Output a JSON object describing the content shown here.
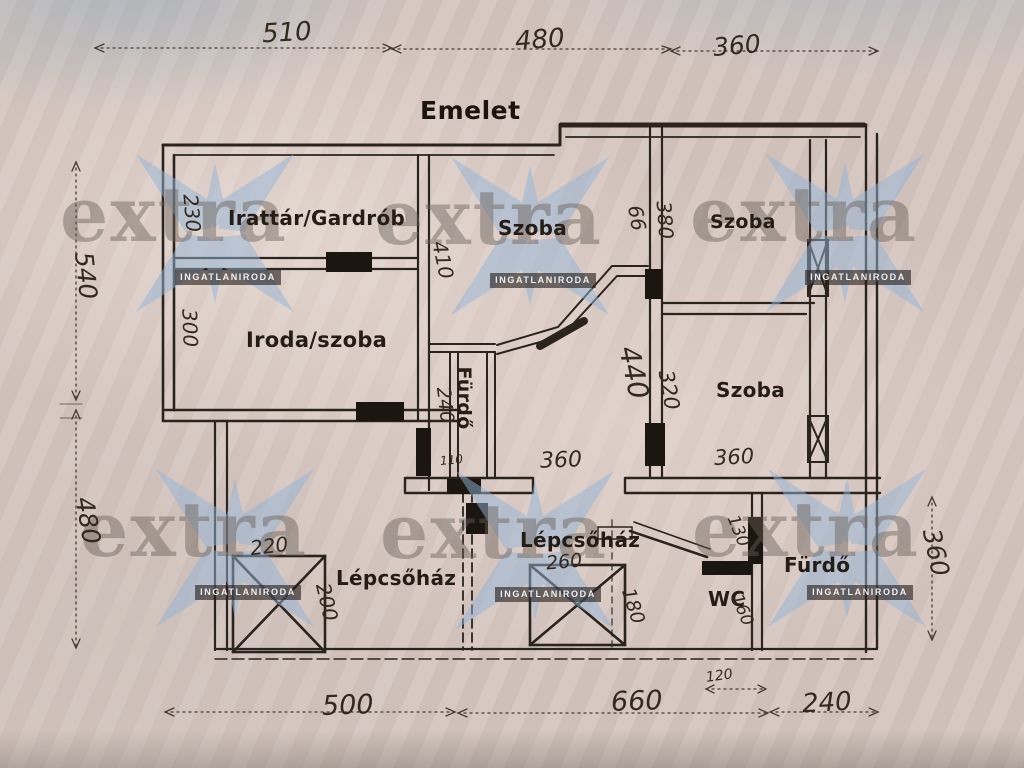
{
  "title": "Emelet",
  "watermark": {
    "brand": "extra",
    "subtitle": "INGATLANIRODA",
    "star_color": "#93b5d8"
  },
  "dims": {
    "top": [
      "510",
      "480",
      "360"
    ],
    "left": [
      "540",
      "480"
    ],
    "right": [
      "360"
    ],
    "bottom": [
      "500",
      "660",
      "120",
      "240"
    ]
  },
  "rooms": {
    "irattar": "Irattár/Gardrób",
    "szoba_mid": "Szoba",
    "szoba_top_right": "Szoba",
    "iroda": "Iroda/szoba",
    "szoba_bottom_right": "Szoba",
    "furdo_mid": "Fürdő",
    "lepcsohaz_left": "Lépcsőház",
    "lepcsohaz_mid": "Lépcsőház",
    "wc": "WC",
    "furdo_right": "Fürdő"
  },
  "inner_dims": {
    "d230": "230",
    "d300": "300",
    "d410": "410",
    "d240_furdo": "240",
    "d110": "110",
    "d66": "66",
    "d380": "380",
    "d440": "440",
    "d320": "320",
    "d360_mid": "360",
    "d360_right": "360",
    "d220": "220",
    "d200": "200",
    "d260": "260",
    "d180": "180",
    "d130": "130",
    "d160": "160"
  },
  "ink_color": "#2b241e"
}
